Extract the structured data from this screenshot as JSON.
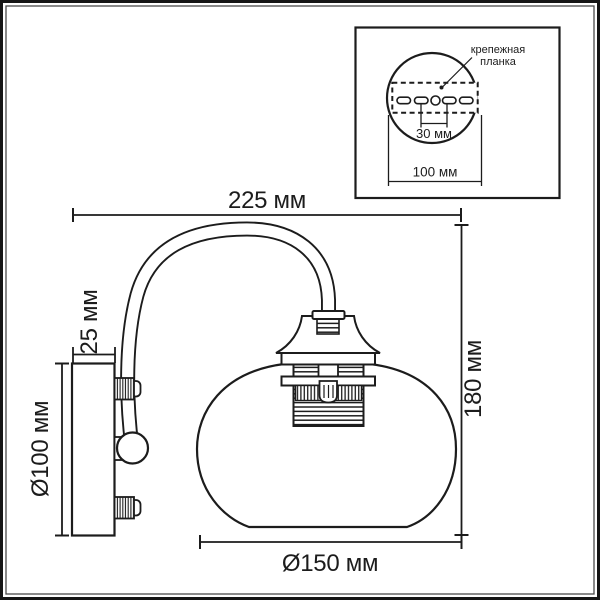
{
  "page": {
    "background": "#ffffff",
    "ink": "#1c1c1c",
    "drawing_type": "wall-lamp dimension drawing"
  },
  "main_view": {
    "dim_width_label": "225 мм",
    "dim_height_label": "180 мм",
    "dim_shade_diameter_label": "Ø150 мм",
    "dim_base_diameter_label": "Ø100 мм",
    "dim_base_depth_label": "25 мм"
  },
  "inset": {
    "callout_line1": "крепежная",
    "callout_line2": "планка",
    "dim_hole_spacing_label": "30 мм",
    "dim_plate_width_label": "100 мм"
  }
}
